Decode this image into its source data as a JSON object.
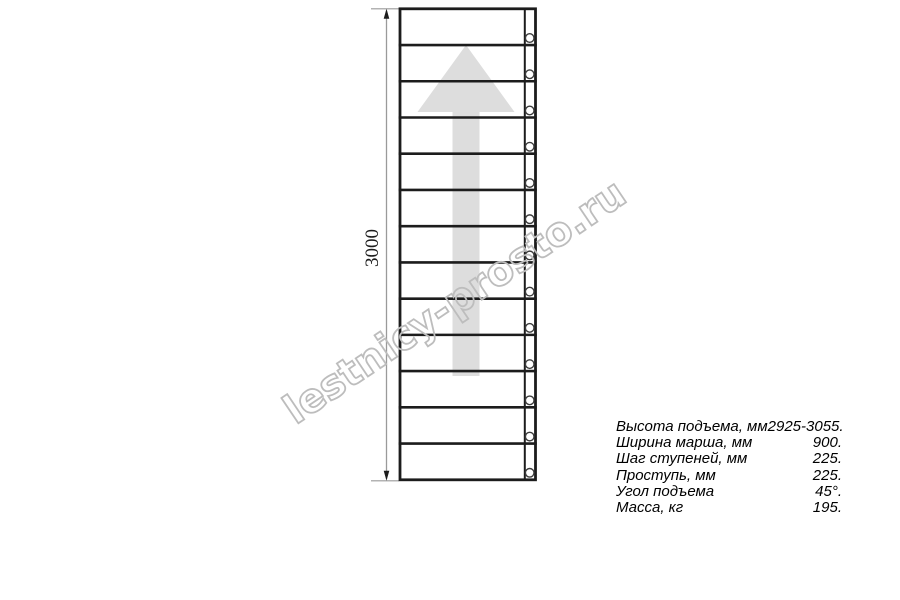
{
  "drawing": {
    "type": "staircase-plan-top-view",
    "dimension_label": "3000",
    "steps_count": 13,
    "direction_arrow": "up",
    "bolts_count": 13
  },
  "colors": {
    "line": "#1c1c1c",
    "bolt_stroke": "#3c3c3c",
    "dimension_line": "#9a9a9a",
    "dimension_arrow": "#1c1c1c",
    "arrow_fill": "#dddddd",
    "watermark_outline": "#bdbdbd",
    "text": "#000000",
    "background": "#ffffff"
  },
  "watermark": {
    "text": "lestnicy-prosto.ru"
  },
  "specs": {
    "rows": [
      {
        "label": "Высота подъема, мм",
        "value": "2925-3055."
      },
      {
        "label": "Ширина марша, мм",
        "value": "900."
      },
      {
        "label": "Шаг ступеней, мм",
        "value": "225."
      },
      {
        "label": "Проступь, мм",
        "value": "225."
      },
      {
        "label": "Угол подъема",
        "value": "45°."
      },
      {
        "label": "Масса, кг",
        "value": "195."
      }
    ]
  }
}
